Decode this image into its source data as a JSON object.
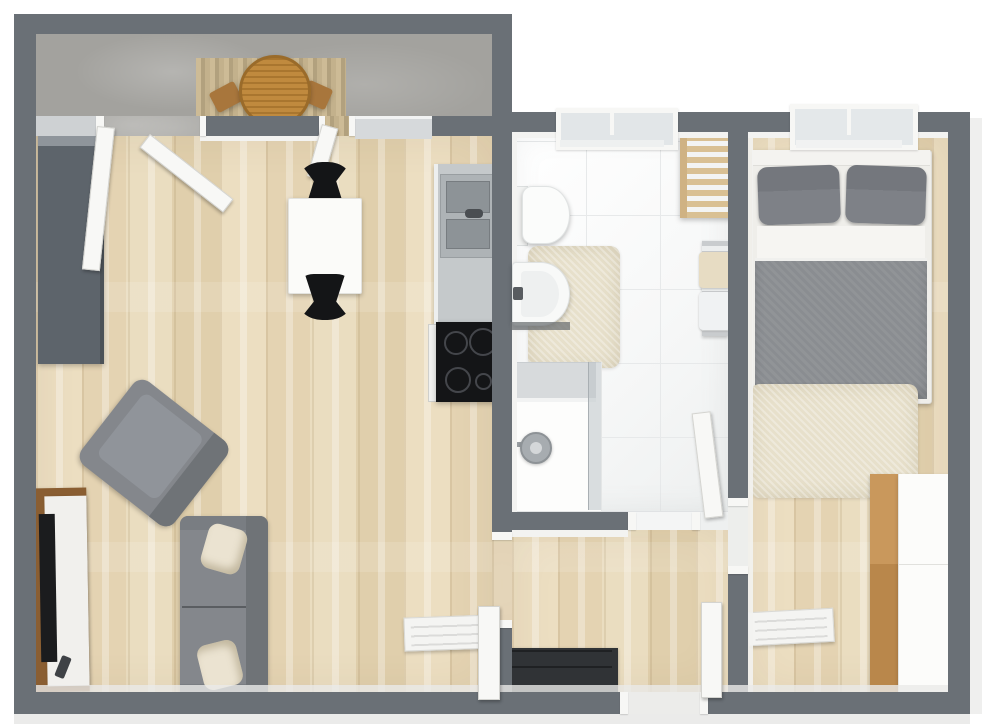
{
  "title": "Apartment 3D Floor Plan (top-down render)",
  "view": "top-down-3d",
  "palette": {
    "wall": "#6a7076",
    "wallLight": "#ced1d3",
    "face": "#f3f3f1",
    "woodA": "#ecdec1",
    "woodB": "#e4d3b2",
    "woodC": "#eaddc0",
    "woodD": "#e0cfac",
    "balcony": "#a3a29e",
    "tile": "#f7f8f8",
    "grout": "#e7e9ea",
    "sofa": "#84878c",
    "sofaDark": "#6f7377",
    "cushion": "#ebe3d1",
    "duvet": "#8a8d91",
    "pillowGray": "#7e8187",
    "rug": "#e7e0cb",
    "tableWood": "#c08a3e",
    "tvWood": "#8a5e32",
    "applianceDark": "#141517",
    "steel": "#aeb3b6",
    "whiteFurniture": "#f8f8f6"
  },
  "rooms": [
    {
      "id": "balcony",
      "name": "Balcony",
      "furniture": [
        "round-slatted-table",
        "balcony-chair-left",
        "balcony-chair-right",
        "wood-decking"
      ]
    },
    {
      "id": "living-room",
      "name": "Living Room with Kitchenette",
      "furniture": [
        "tall-gray-cabinet",
        "dining-table",
        "dining-chair-top",
        "dining-chair-bottom",
        "kitchen-counter",
        "double-steel-sink",
        "cooktop-4-burners",
        "oven-front",
        "gray-sofa",
        "cream-throw-pillow-1",
        "cream-throw-pillow-2",
        "gray-armchair",
        "tv-sideboard",
        "flat-tv",
        "remote-control",
        "wall-radiator"
      ]
    },
    {
      "id": "bathroom",
      "name": "Bathroom",
      "furniture": [
        "toilet",
        "washbasin",
        "beige-bath-rug",
        "wooden-ladder-shelf",
        "towel-radiator-with-towels",
        "walk-in-shower",
        "shower-head"
      ]
    },
    {
      "id": "hallway",
      "name": "Hallway",
      "furniture": [
        "shoe-bench-with-dark-doormat"
      ]
    },
    {
      "id": "bedroom",
      "name": "Bedroom",
      "furniture": [
        "double-bed-gray-duvet",
        "gray-pillow-left",
        "gray-pillow-right",
        "beige-bedroom-rug",
        "wardrobe-white-and-wood",
        "wall-radiator"
      ]
    }
  ],
  "openings": {
    "windows": [
      "bathroom-window",
      "bedroom-window",
      "kitchen-window-band"
    ],
    "doors": [
      "balcony-door-left",
      "balcony-door-right",
      "living-to-hallway-door",
      "bathroom-door",
      "bedroom-door",
      "front-entrance-door"
    ]
  }
}
